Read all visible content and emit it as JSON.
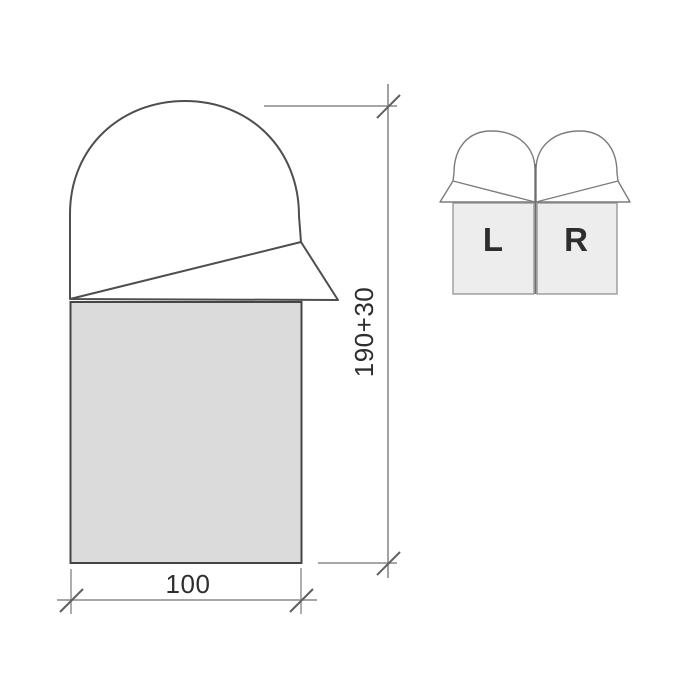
{
  "diagram": {
    "main_figure": {
      "height_label": "190+30",
      "width_label": "100"
    },
    "pair_figure": {
      "left_label": "L",
      "right_label": "R"
    },
    "colors": {
      "background": "#ffffff",
      "body_fill": "#dbdbdb",
      "pair_body_fill": "#ededed",
      "outline": "#4e4e4e",
      "pair_outline": "#7d7d7d",
      "dimension_line": "#8a8a8a",
      "tick_mark": "#606060",
      "label_text": "#2e2e2e",
      "pair_label_text": "#141414"
    }
  }
}
